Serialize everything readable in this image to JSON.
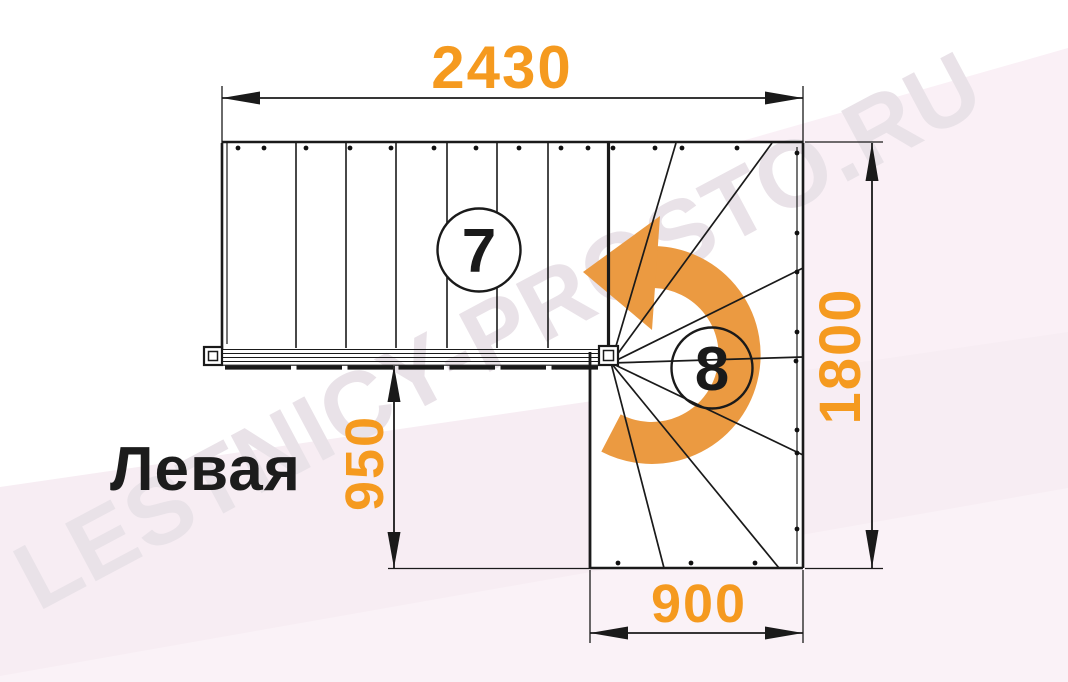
{
  "diagram": {
    "type": "staircase-plan",
    "orientation_label": "Левая",
    "straight_flight_step_count": "7",
    "winder_step_count": "8",
    "dimensions": {
      "top_width_mm": "2430",
      "right_height_mm": "1800",
      "left_height_mm": "950",
      "bottom_width_mm": "900"
    },
    "watermark_text": "LESTNICY-PROSTO.RU",
    "colors": {
      "dimension_text": "#F59A1F",
      "turn_arrow": "#EB9A41",
      "line": "#1A1A1A",
      "background_pink": "#F7EDF3",
      "background_pink_light": "#FAF0F6",
      "background_pink_lighter": "#FAF2F7",
      "watermark": "#E9E2E8",
      "circle_fill": "#FFFFFF"
    }
  }
}
